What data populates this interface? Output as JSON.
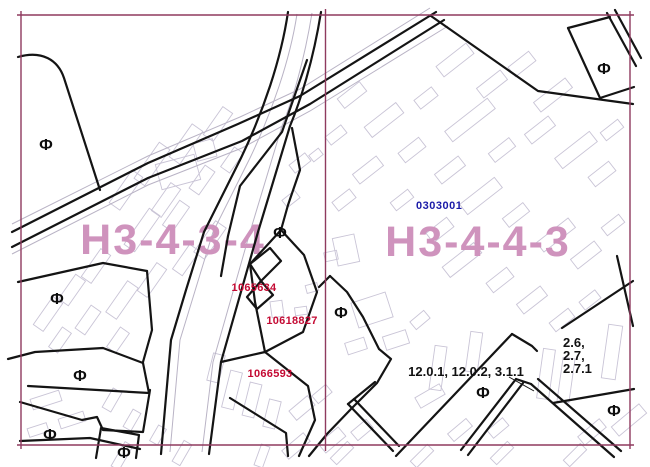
{
  "map": {
    "zone_labels": [
      {
        "code": "Н3-4-3-4"
      },
      {
        "code": "Н3-4-4-3"
      }
    ],
    "street_name": "ИЗВИЛИСТЫЙ ПРОЕЗД",
    "cadastral_quarter_number": "0303001",
    "parcel_numbers": [
      "1065634",
      "10618827",
      "1066593"
    ],
    "land_use_codes_main": "12.0.1, 12.0.2, 3.1.1",
    "land_use_codes_lines": [
      "2.6,",
      "2.7,",
      "2.7.1"
    ],
    "functional_marker": "Ф",
    "colors": {
      "zone_label": "#cf93bd",
      "frame_border": "#8f3a5f",
      "parcel_number": "#c40a33",
      "quarter_number": "#1a1aa8",
      "boundary_line": "#141414",
      "building_outline": "#c9c4d6",
      "use_code_text": "#111111",
      "street_name_text": "#404040"
    }
  }
}
